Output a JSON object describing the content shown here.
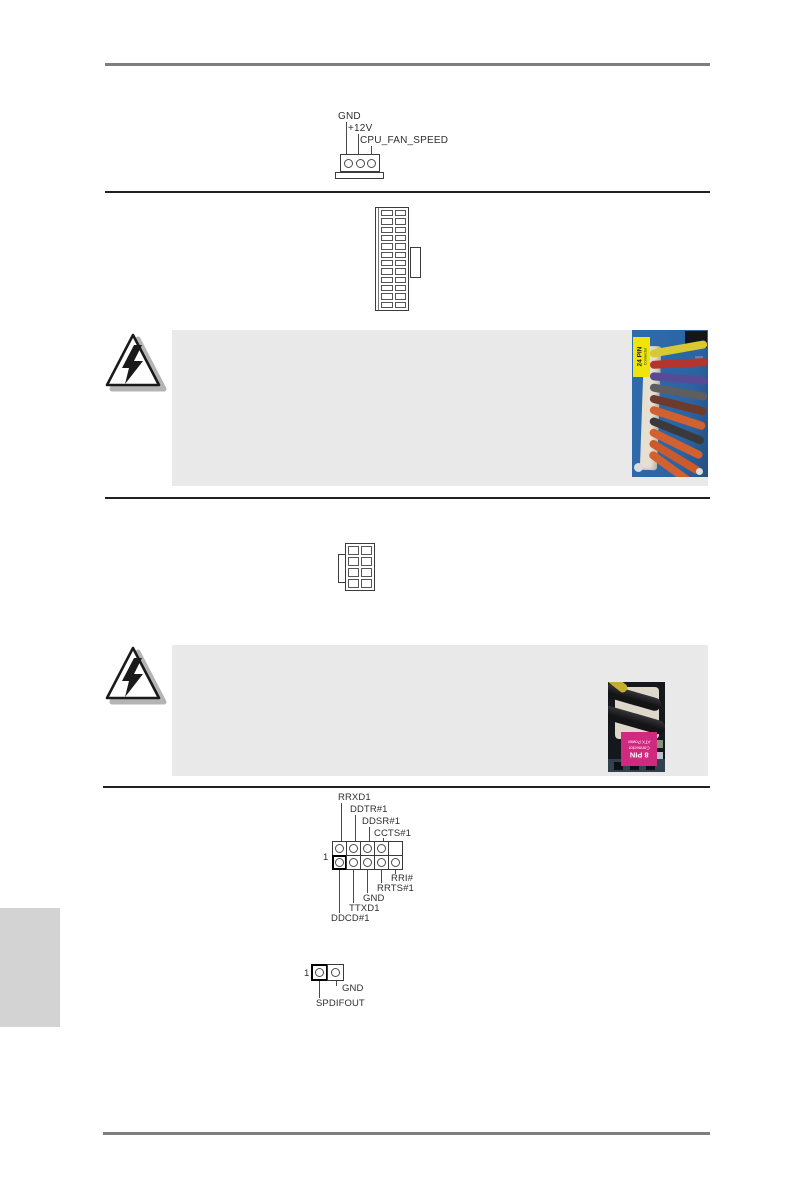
{
  "connectors": {
    "cpu_fan": {
      "labels": {
        "gnd": "GND",
        "v12": "+12V",
        "speed": "CPU_FAN_SPEED"
      }
    },
    "serial": {
      "pin1": "1",
      "top_labels": [
        "RRXD1",
        "DDTR#1",
        "DDSR#1",
        "CCTS#1"
      ],
      "bottom_labels": [
        "RRI#",
        "RRTS#1",
        "GND",
        "TTXD1",
        "DDCD#1"
      ]
    },
    "spdif": {
      "pin1": "1",
      "gnd": "GND",
      "out": "SPDIFOUT"
    }
  },
  "photos": {
    "atx24_sticker": {
      "big": "24 PIN",
      "small": "Connector",
      "color": "#efe50c"
    },
    "atx8_sticker": {
      "big": "8 PIN",
      "small1": "ATX Power",
      "small2": "Connector",
      "color": "#d02a80"
    }
  },
  "colors": {
    "note_box_bg": "#e9e9e9",
    "language_tab_bg": "#d3d3d3",
    "rule_gray": "#7e7e7e",
    "separator_dark": "#212121",
    "pcb_blue": "#2f6cae"
  }
}
